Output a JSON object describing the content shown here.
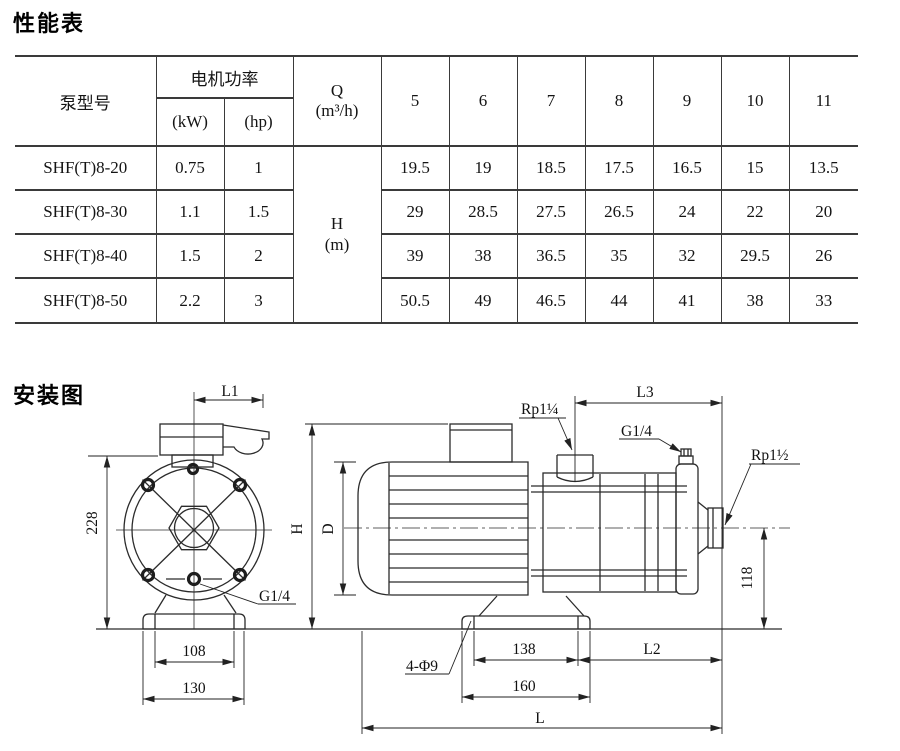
{
  "page": {
    "background": "#ffffff",
    "ink": "#1a1a1a",
    "line": "#2b2b2b"
  },
  "perf": {
    "title": "性能表",
    "headers": {
      "model": "泵型号",
      "power": "电机功率",
      "kw": "(kW)",
      "hp": "(hp)",
      "q_line1": "Q",
      "q_line2": "(m³/h)",
      "h_line1": "H",
      "h_line2": "(m)"
    },
    "flow": [
      "5",
      "6",
      "7",
      "8",
      "9",
      "10",
      "11"
    ],
    "rows": [
      {
        "model": "SHF(T)8-20",
        "kw": "0.75",
        "hp": "1",
        "head": [
          "19.5",
          "19",
          "18.5",
          "17.5",
          "16.5",
          "15",
          "13.5"
        ]
      },
      {
        "model": "SHF(T)8-30",
        "kw": "1.1",
        "hp": "1.5",
        "head": [
          "29",
          "28.5",
          "27.5",
          "26.5",
          "24",
          "22",
          "20"
        ]
      },
      {
        "model": "SHF(T)8-40",
        "kw": "1.5",
        "hp": "2",
        "head": [
          "39",
          "38",
          "36.5",
          "35",
          "32",
          "29.5",
          "26"
        ]
      },
      {
        "model": "SHF(T)8-50",
        "kw": "2.2",
        "hp": "3",
        "head": [
          "50.5",
          "49",
          "46.5",
          "44",
          "41",
          "38",
          "33"
        ]
      }
    ]
  },
  "install": {
    "title": "安装图",
    "labels": {
      "l1": "L1",
      "d228": "228",
      "d108": "108",
      "d130": "130",
      "g14_front": "G1/4",
      "h": "H",
      "d": "D",
      "rp1_quarter": "Rp1¼",
      "g14_side": "G1/4",
      "rp1_half": "Rp1½",
      "l3": "L3",
      "d118": "118",
      "holes": "4-Φ9",
      "d138": "138",
      "l2": "L2",
      "d160": "160",
      "l": "L"
    }
  }
}
